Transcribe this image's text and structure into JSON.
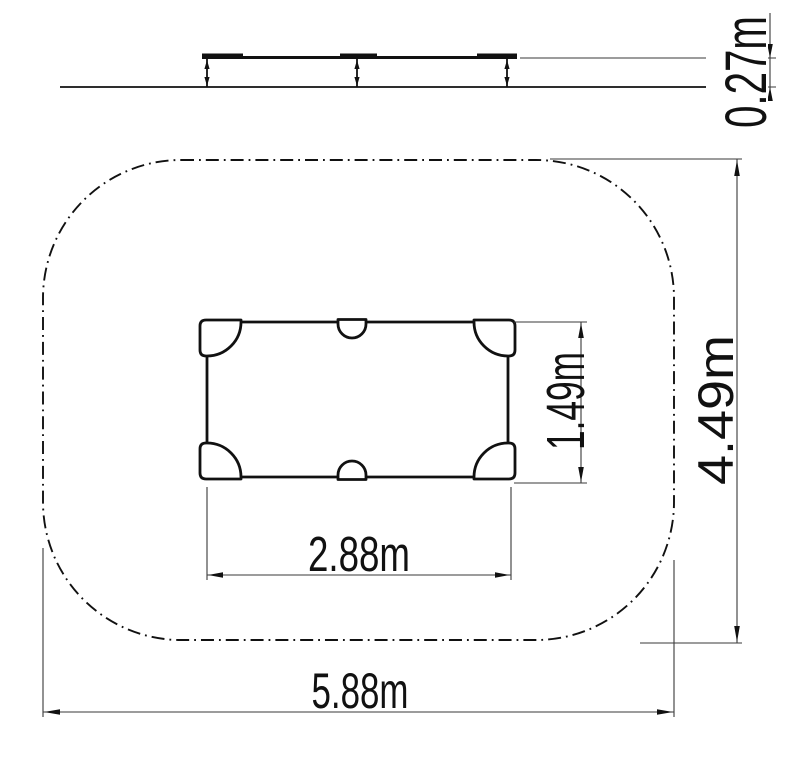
{
  "drawing": {
    "type": "technical-dimension-drawing",
    "side_view": {
      "height_label": "0.27m"
    },
    "plan_view": {
      "equipment_width_label": "2.88m",
      "equipment_depth_label": "1.49m",
      "safety_zone_width_label": "5.88m",
      "safety_zone_depth_label": "4.49m"
    }
  },
  "colors": {
    "line": "#111111",
    "dimension_line": "#3a3a3a",
    "background": "#ffffff"
  }
}
